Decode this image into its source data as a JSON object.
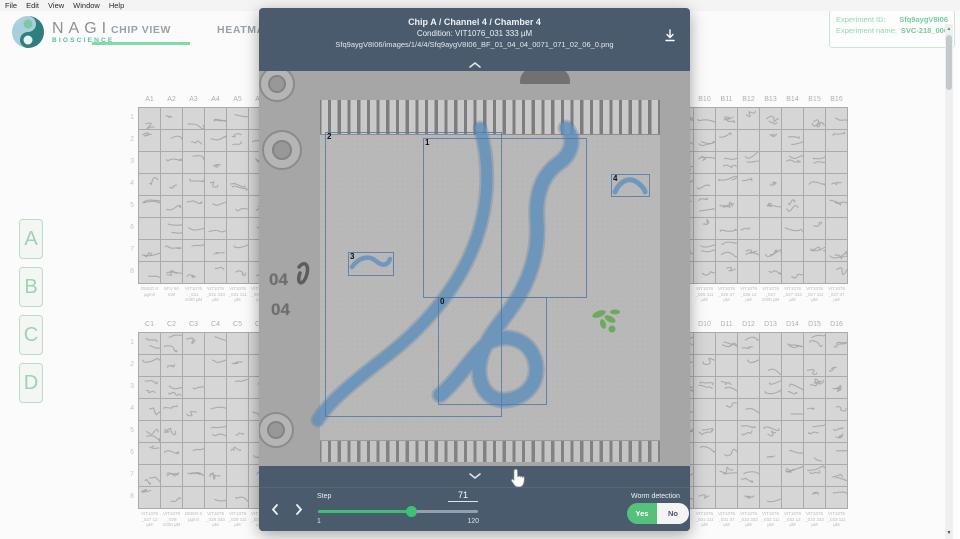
{
  "menu_bar": {
    "items": [
      "File",
      "Edit",
      "View",
      "Window",
      "Help"
    ]
  },
  "header": {
    "brand": {
      "name": "NAGI",
      "subtitle": "BIOSCIENCE"
    },
    "tabs": [
      {
        "label": "CHIP VIEW",
        "active": true
      },
      {
        "label": "HEATMAP VIEW",
        "active": false
      }
    ],
    "experiment": {
      "id_label": "Experiment ID:",
      "id_value": "Sfq9aygV8I06",
      "name_label": "Experiment name:",
      "name_value": "SVC-218_006"
    }
  },
  "chip_selector": {
    "buttons": [
      "A",
      "B",
      "C",
      "D"
    ]
  },
  "chip_grids": {
    "row_labels": [
      "1",
      "2",
      "3",
      "4",
      "5",
      "6",
      "7",
      "8"
    ],
    "banks": [
      {
        "id": "A",
        "position": "top-left",
        "columns": [
          "A1",
          "A2",
          "A3",
          "A4",
          "A5",
          "A6",
          "A7",
          "A8",
          "A9",
          "A10",
          "A11",
          "A12",
          "A13",
          "A14",
          "A15",
          "A16"
        ],
        "conditions": [
          "DMSO 0 µg/ml",
          "5FU 50 mM",
          "VIT1076 _031 1000 µM",
          "VIT1076 _031 333 µM",
          "VIT1076 _031 111 µM",
          "VIT1076 _031 37 µM",
          "",
          "",
          "",
          "",
          "",
          "",
          "",
          "",
          "",
          ""
        ]
      },
      {
        "id": "B",
        "position": "top-right",
        "columns": [
          "B1",
          "B2",
          "B3",
          "B4",
          "B5",
          "B6",
          "B7",
          "B8",
          "B9",
          "B10",
          "B11",
          "B12",
          "B13",
          "B14",
          "B15",
          "B16"
        ],
        "conditions": [
          "",
          "",
          "",
          "",
          "",
          "",
          "",
          "",
          "",
          "VIT1076 _025 111 µM",
          "VIT1076 _025 37 µM",
          "VIT1076 _025 12 µM",
          "VIT1076 _027 1000 µM",
          "VIT1076 _027 333 µM",
          "VIT1076 _027 111 µM",
          "VIT1076 _027 37 µM"
        ]
      },
      {
        "id": "C",
        "position": "bottom-left",
        "columns": [
          "C1",
          "C2",
          "C3",
          "C4",
          "C5",
          "C6",
          "C7",
          "C8",
          "C9",
          "C10",
          "C11",
          "C12",
          "C13",
          "C14",
          "C15",
          "C16"
        ],
        "conditions": [
          "VIT1079 _027 12 µM",
          "VIT1079 _028 1000 µM",
          "DMSO 0 µg/ml",
          "VIT1079 _028 333 µM",
          "VIT1079 _028 111 µM",
          "VIT1079 _028 37 µM",
          "",
          "",
          "",
          "",
          "",
          "",
          "",
          "",
          "",
          ""
        ]
      },
      {
        "id": "D",
        "position": "bottom-right",
        "columns": [
          "D1",
          "D2",
          "D3",
          "D4",
          "D5",
          "D6",
          "D7",
          "D8",
          "D9",
          "D10",
          "D11",
          "D12",
          "D13",
          "D14",
          "D15",
          "D16"
        ],
        "conditions": [
          "",
          "",
          "",
          "",
          "",
          "",
          "",
          "",
          "",
          "VIT1076 _031 111 µM",
          "VIT1076 _031 37 µM",
          "VIT1076 _032 333 µM",
          "VIT1076 _032 111 µM",
          "VIT1076 _032 12 µM",
          "VIT1076 _033 333 µM",
          "VIT1076 _033 111 µM"
        ]
      }
    ]
  },
  "modal": {
    "title": "Chip A / Channel 4 / Chamber 4",
    "condition_line": "Condition: VIT1076_031 333 µM",
    "image_path": "Sfq9aygV8I06/images/1/4/4/Sfq9aygV8I06_BF_01_04_04_0071_071_02_06_0.png",
    "chamber_well_labels": [
      "04",
      "04"
    ],
    "detections": [
      {
        "label": "0",
        "x": 179,
        "y": 226,
        "w": 107,
        "h": 106
      },
      {
        "label": "1",
        "x": 164,
        "y": 67,
        "w": 162,
        "h": 158
      },
      {
        "label": "2",
        "x": 66,
        "y": 61,
        "w": 175,
        "h": 283
      },
      {
        "label": "3",
        "x": 89,
        "y": 181,
        "w": 44,
        "h": 22
      },
      {
        "label": "4",
        "x": 352,
        "y": 103,
        "w": 37,
        "h": 21
      }
    ],
    "controls": {
      "step_label": "Step",
      "step_value": "71",
      "range_min": "1",
      "range_max": "120",
      "worm_detection_label": "Worm detection",
      "yes_label": "Yes",
      "no_label": "No"
    }
  },
  "colors": {
    "accent_green": "#55c17b",
    "tab_underline": "#7edca4",
    "modal_bar": "#4a5b6e",
    "worm_blue": "#5d8fba",
    "worm_green": "#62a84f"
  }
}
